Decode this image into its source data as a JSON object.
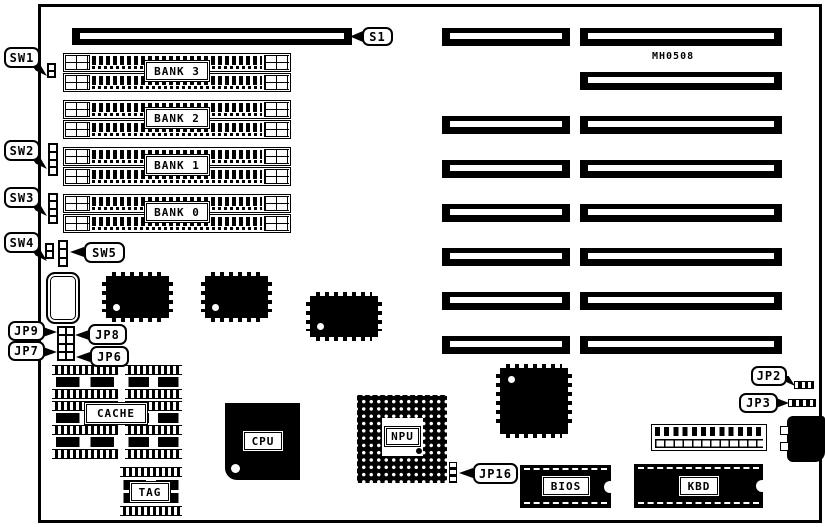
{
  "diagram": {
    "part_number": "MH0508",
    "callouts": {
      "s1": "S1",
      "sw1": "SW1",
      "sw2": "SW2",
      "sw3": "SW3",
      "sw4": "SW4",
      "sw5": "SW5",
      "jp2": "JP2",
      "jp3": "JP3",
      "jp6": "JP6",
      "jp7": "JP7",
      "jp8": "JP8",
      "jp9": "JP9",
      "jp16": "JP16"
    },
    "memory_banks": [
      "BANK 3",
      "BANK 2",
      "BANK 1",
      "BANK 0"
    ],
    "chip_labels": {
      "cache": "CACHE",
      "tag": "TAG",
      "cpu": "CPU",
      "npu": "NPU",
      "bios": "BIOS",
      "kbd": "KBD"
    }
  }
}
